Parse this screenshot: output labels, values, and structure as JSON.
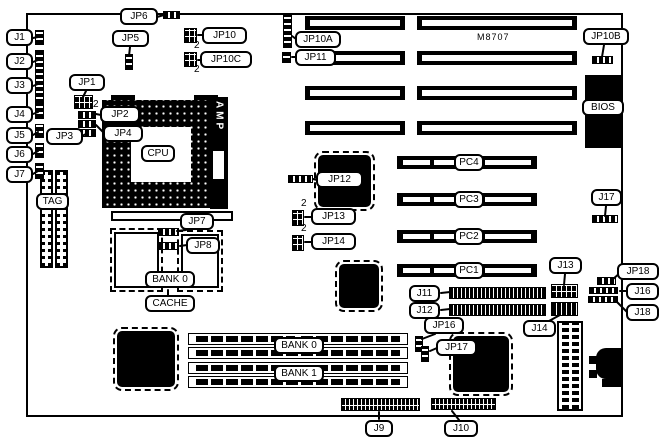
{
  "diagram": {
    "kind": "motherboard-layout",
    "model": "M8707",
    "colors": {
      "background": "#ffffff",
      "line": "#000000",
      "chip_fill": "#000000"
    }
  },
  "chips": {
    "cpu": "CPU",
    "amp": "AMP",
    "tag": "TAG",
    "bios": "BIOS"
  },
  "cache": {
    "bank": "BANK 0",
    "title": "CACHE"
  },
  "memory": {
    "bank0": "BANK 0",
    "bank1": "BANK 1"
  },
  "slots": {
    "pci": [
      "PC1",
      "PC2",
      "PC3",
      "PC4"
    ]
  },
  "jumpers": {
    "jp1": "JP1",
    "jp2": "JP2",
    "jp3": "JP3",
    "jp4": "JP4",
    "jp5": "JP5",
    "jp6": "JP6",
    "jp7": "JP7",
    "jp8": "JP8",
    "jp10": "JP10",
    "jp10a": "JP10A",
    "jp10b": "JP10B",
    "jp10c": "JP10C",
    "jp11": "JP11",
    "jp12": "JP12",
    "jp13": "JP13",
    "jp14": "JP14",
    "jp16": "JP16",
    "jp17": "JP17",
    "jp18": "JP18",
    "pin2_marker": "2"
  },
  "connectors": {
    "j1": "J1",
    "j2": "J2",
    "j3": "J3",
    "j4": "J4",
    "j5": "J5",
    "j6": "J6",
    "j7": "J7",
    "j9": "J9",
    "j10": "J10",
    "j11": "J11",
    "j12": "J12",
    "j13": "J13",
    "j14": "J14",
    "j16": "J16",
    "j17": "J17",
    "j18": "J18"
  }
}
